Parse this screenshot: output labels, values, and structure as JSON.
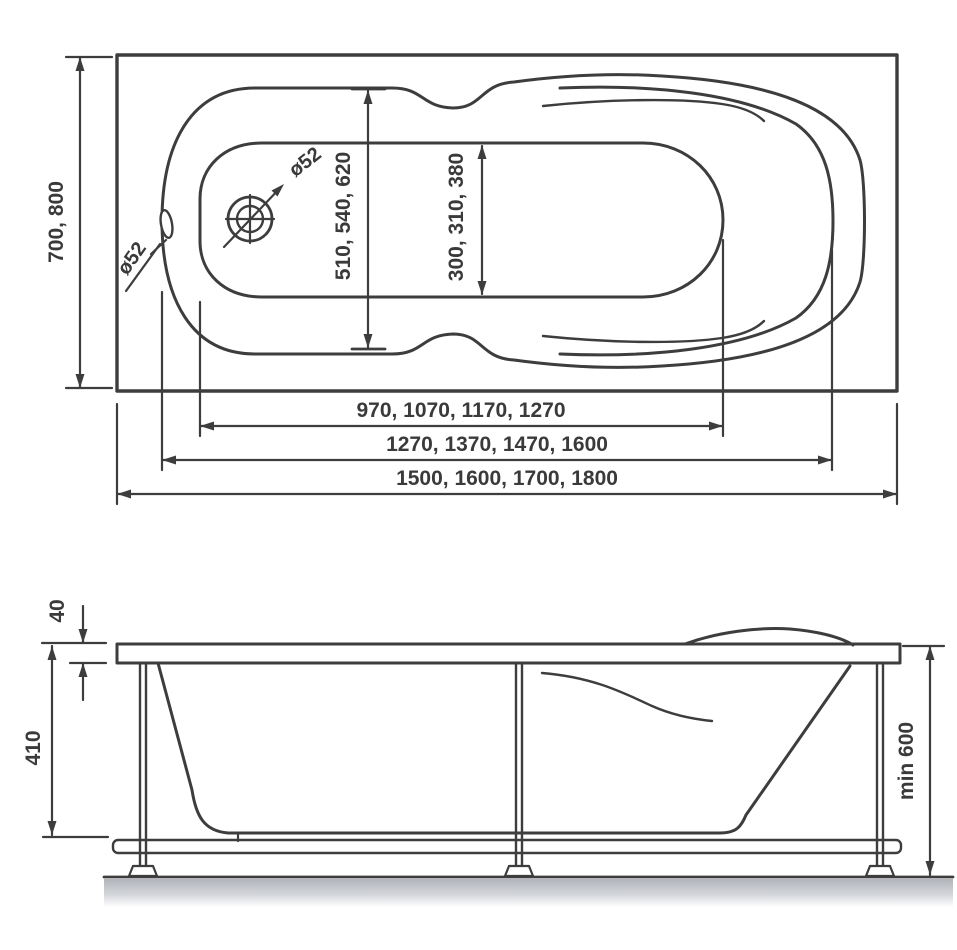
{
  "top_view": {
    "overall_width_label": "700, 800",
    "inner_width_label": "510, 540, 620",
    "bottom_width_label": "300, 310, 380",
    "bottom_length_label": "970, 1070, 1170, 1270",
    "inner_length_label": "1270, 1370, 1470, 1600",
    "overall_length_label": "1500, 1600, 1700, 1800",
    "drain_diameter_label": "ø52",
    "overflow_diameter_label": "ø52"
  },
  "side_view": {
    "rim_thickness_label": "40",
    "depth_label": "410",
    "min_height_label": "min 600"
  },
  "colors": {
    "line": "#3d3d3d",
    "text": "#3a3a3a",
    "shadow": "#b1b4ba",
    "background": "#ffffff"
  }
}
